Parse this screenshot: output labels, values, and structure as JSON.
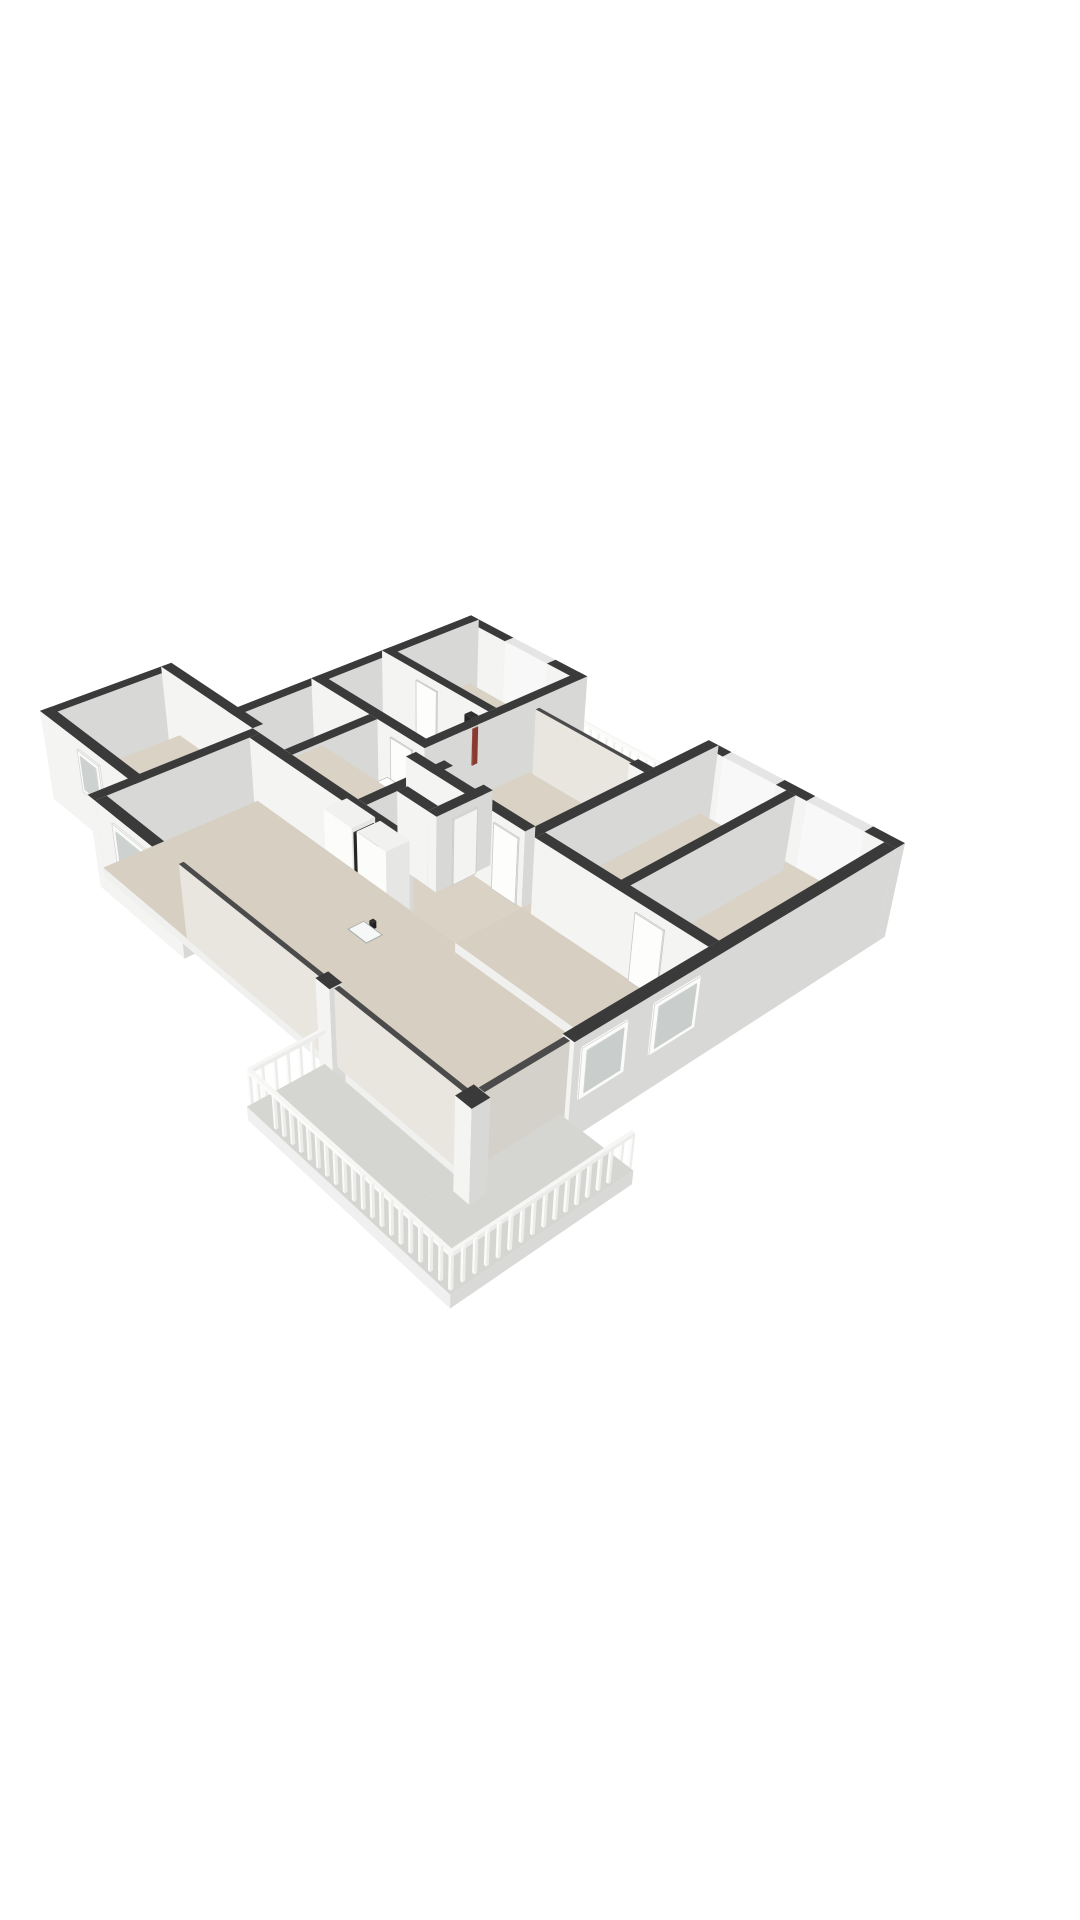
{
  "meta": {
    "description": "3D isometric floor plan of an apartment, viewed from the south-east above. White background, dark wall caps, white and grey walls, beige room floors, grey balcony floors, two balconies with white slatted railings, kitchen island with cooktop and sink, bathroom with wooden vanity, bathtub and shower, utility closet with boiler and meter cupboard.",
    "image_width": 1080,
    "image_height": 1920
  },
  "palette": {
    "background": "#ffffff",
    "wall_top": "#3a3a3b",
    "wall_south_face": "#f4f4f3",
    "wall_east_face": "#d8d8d7",
    "floor_room": "#d9d2c5",
    "floor_living": "#d7cfc1",
    "floor_balcony": "#d5d6d1",
    "railing_white": "#f6f6f5",
    "glass_face": "#e9e6e0",
    "furniture_white": "#f1f1ef",
    "wood_vanity": "#cfa87f",
    "cooktop_black": "#1d1d1f",
    "dark_cabinet": "#262627",
    "accent_red": "#8a3b2f",
    "door_white": "#fdfdfc"
  },
  "camera": {
    "eye": [
      33.0,
      29.9,
      24.9
    ],
    "target": [
      7.0,
      8.0,
      0.0
    ],
    "fit_frame": [
      40,
      428,
      905,
      1496
    ]
  },
  "kinds": {
    "wall": {
      "ft": "#3a3a3b",
      "fs": "#f4f4f3",
      "fe": "#d8d8d7"
    },
    "winN": {
      "ft": "#e4e5e4",
      "fs": "#f7f8f7",
      "fe": "#edeeed"
    },
    "glass": {
      "ft": "#4b4b4c",
      "fs": "#e9e6e0",
      "fe": "#d4d1ca"
    },
    "slab": {
      "ft": "#d9d2c5",
      "fs": "#f0f0ef",
      "fe": "#dadad9"
    },
    "slabL": {
      "ft": "#d7cfc1",
      "fs": "#f0f0ef",
      "fe": "#dadad9"
    },
    "slabB": {
      "ft": "#d5d6d1",
      "fs": "#eff0ef",
      "fe": "#d9dad8"
    },
    "rail": {
      "ft": "#f6f6f5",
      "fs": "#fbfbfa",
      "fe": "#ececeb"
    },
    "furn": {
      "ft": "#f1f1ef",
      "fs": "#fcfcfb",
      "fe": "#e6e6e4"
    },
    "wood": {
      "ft": "#f7f6f3",
      "fs": "#cfa87f",
      "fe": "#b8905e"
    },
    "dark": {
      "ft": "#2e2e2f",
      "fs": "#262627",
      "fe": "#1f1f20"
    },
    "door": {
      "ft": "#fdfdfc",
      "fs": "#fdfdfc",
      "fe": "#f3f3f1",
      "stroke": "#c9c9c7"
    },
    "dec": {}
  },
  "boxes": [
    {
      "id": "wall-wing-north-a",
      "k": "wall",
      "b": [
        -0.2,
        -0.2,
        1.7,
        0.15,
        -0.55,
        2.35
      ]
    },
    {
      "id": "window-wing-north",
      "k": "winN",
      "b": [
        1.7,
        -0.2,
        3.5,
        0.15,
        -0.55,
        2.35
      ]
    },
    {
      "id": "wall-wing-north-b",
      "k": "wall",
      "b": [
        3.5,
        -0.2,
        4.8,
        0.15,
        -0.55,
        2.35
      ]
    },
    {
      "id": "wall-wing-west",
      "k": "wall",
      "b": [
        -0.2,
        -0.2,
        0.15,
        8.95,
        -0.55,
        2.35
      ]
    },
    {
      "id": "wall-wing-east",
      "k": "wall",
      "b": [
        4.45,
        -0.2,
        4.8,
        5.9,
        0,
        2.35
      ]
    },
    {
      "id": "wall-study-south",
      "k": "wall",
      "b": [
        -0.2,
        3.0,
        4.45,
        3.3,
        0,
        2.35
      ]
    },
    {
      "id": "wall-wing-south",
      "k": "wall",
      "b": [
        -0.2,
        5.55,
        4.8,
        5.9,
        0,
        2.35
      ]
    },
    {
      "id": "wall-bed1-north-a",
      "k": "wall",
      "b": [
        4.8,
        1.95,
        5.15,
        2.3,
        0,
        2.35
      ]
    },
    {
      "id": "slider-bed1-balcony",
      "k": "glass",
      "b": [
        5.15,
        2.02,
        8.85,
        2.16,
        0,
        2.3
      ]
    },
    {
      "id": "wall-bed1-north-b",
      "k": "wall",
      "b": [
        8.85,
        1.95,
        9.4,
        2.3,
        0,
        2.35
      ]
    },
    {
      "id": "wall-block-west",
      "k": "wall",
      "b": [
        9.4,
        -0.2,
        9.75,
        6.55,
        0,
        2.35
      ]
    },
    {
      "id": "wall-block-north-a",
      "k": "wall",
      "b": [
        9.75,
        -0.2,
        10.2,
        0.15,
        -0.55,
        2.35
      ]
    },
    {
      "id": "window-block-north-1",
      "k": "winN",
      "b": [
        10.2,
        -0.2,
        12.0,
        0.15,
        -0.55,
        2.35
      ]
    },
    {
      "id": "wall-block-north-b",
      "k": "wall",
      "b": [
        12.0,
        -0.2,
        13.0,
        0.15,
        -0.55,
        2.35
      ]
    },
    {
      "id": "window-block-north-2",
      "k": "winN",
      "b": [
        13.0,
        -0.2,
        14.8,
        0.15,
        -0.55,
        2.35
      ]
    },
    {
      "id": "wall-block-north-c",
      "k": "wall",
      "b": [
        14.8,
        -0.2,
        15.75,
        0.15,
        -0.55,
        2.35
      ]
    },
    {
      "id": "wall-east-facade",
      "k": "wall",
      "b": [
        15.4,
        0.15,
        15.75,
        11.1,
        -0.55,
        2.35
      ]
    },
    {
      "id": "slider-corner-east",
      "k": "glass",
      "b": [
        15.44,
        11.1,
        15.62,
        13.5,
        0,
        2.3
      ]
    },
    {
      "id": "column-corner",
      "k": "wall",
      "b": [
        15.35,
        13.55,
        15.85,
        14.05,
        -0.4,
        2.35
      ]
    },
    {
      "id": "wall-bed-divider",
      "k": "wall",
      "b": [
        12.35,
        0.15,
        12.65,
        6.55,
        0,
        2.35
      ]
    },
    {
      "id": "wall-bed1-south",
      "k": "wall",
      "b": [
        4.8,
        6.2,
        9.4,
        6.55,
        0,
        2.35
      ]
    },
    {
      "id": "wall-block-south",
      "k": "wall",
      "b": [
        9.75,
        6.2,
        15.4,
        6.55,
        0,
        2.35
      ]
    },
    {
      "id": "wall-bath-west",
      "k": "wall",
      "b": [
        2.45,
        5.9,
        2.8,
        8.8,
        0,
        2.35
      ]
    },
    {
      "id": "wall-bath-east",
      "k": "wall",
      "b": [
        5.6,
        5.9,
        5.95,
        8.8,
        0,
        2.35
      ]
    },
    {
      "id": "wall-toilet-east",
      "k": "wall",
      "b": [
        7.15,
        5.9,
        7.5,
        7.8,
        0,
        2.35
      ]
    },
    {
      "id": "wall-toilet-south",
      "k": "wall",
      "b": [
        5.95,
        7.45,
        7.15,
        7.8,
        0,
        2.35
      ]
    },
    {
      "id": "wall-kitchen-divider",
      "k": "wall",
      "b": [
        1.35,
        8.8,
        7.8,
        9.15,
        0,
        2.35
      ]
    },
    {
      "id": "wall-leftwing-north",
      "k": "wall",
      "b": [
        -3.55,
        8.45,
        1.0,
        8.8,
        -0.55,
        2.35
      ]
    },
    {
      "id": "wall-leftwing-west",
      "k": "wall",
      "b": [
        -3.55,
        8.8,
        -3.2,
        12.75,
        -0.55,
        2.35
      ]
    },
    {
      "id": "wall-leftwing-south",
      "k": "wall",
      "b": [
        -3.55,
        12.4,
        1.35,
        12.75,
        -0.55,
        2.35
      ]
    },
    {
      "id": "wall-living-west",
      "k": "wall",
      "b": [
        1.0,
        8.8,
        1.35,
        13.95,
        -0.55,
        2.35
      ]
    },
    {
      "id": "wall-living-south-a",
      "k": "wall",
      "b": [
        1.35,
        13.6,
        5.0,
        13.95,
        -0.55,
        2.35
      ]
    },
    {
      "id": "slider-living-south",
      "k": "glass",
      "b": [
        5.0,
        13.68,
        10.6,
        13.82,
        0,
        2.3
      ]
    },
    {
      "id": "wall-living-south-b",
      "k": "wall",
      "b": [
        10.6,
        13.6,
        11.1,
        13.95,
        -0.55,
        2.35
      ]
    },
    {
      "id": "slider-corner-south",
      "k": "glass",
      "b": [
        11.1,
        13.68,
        15.35,
        13.82,
        0,
        2.3
      ]
    },
    {
      "id": "floor-wing",
      "k": "slab",
      "b": [
        -0.2,
        -0.2,
        4.8,
        5.9,
        -0.3,
        0
      ]
    },
    {
      "id": "floor-hall-bath",
      "k": "slab",
      "b": [
        -0.2,
        5.6,
        9.4,
        8.8,
        -0.3,
        0
      ]
    },
    {
      "id": "floor-bed1",
      "k": "slab",
      "b": [
        4.8,
        1.95,
        9.4,
        6.4,
        -0.3,
        0
      ]
    },
    {
      "id": "floor-block",
      "k": "slab",
      "b": [
        9.4,
        -0.2,
        15.6,
        6.55,
        -0.3,
        0
      ]
    },
    {
      "id": "floor-dining",
      "k": "slabL",
      "b": [
        9.4,
        6.55,
        15.6,
        8.8,
        -0.3,
        0
      ]
    },
    {
      "id": "floor-living",
      "k": "slabL",
      "b": [
        1.0,
        8.8,
        15.6,
        13.8,
        -0.3,
        0
      ]
    },
    {
      "id": "floor-leftwing",
      "k": "slab",
      "b": [
        -3.4,
        8.5,
        1.35,
        12.6,
        -0.3,
        0
      ]
    },
    {
      "id": "floor-balcony-top",
      "k": "slabB",
      "b": [
        4.6,
        -0.05,
        9.4,
        1.95,
        -0.35,
        -0.04
      ]
    },
    {
      "id": "floor-balcony-south-a",
      "k": "slabB",
      "b": [
        10.8,
        13.95,
        15.4,
        16.1,
        -0.45,
        -0.04
      ]
    },
    {
      "id": "floor-balcony-south-b",
      "k": "slabB",
      "b": [
        15.4,
        11.0,
        17.6,
        16.1,
        -0.45,
        -0.04
      ]
    },
    {
      "id": "kitchen-island",
      "k": "furn",
      "b": [
        6.2,
        10.6,
        9.3,
        11.4,
        0,
        0.95
      ]
    },
    {
      "id": "cooktop",
      "k": "dec",
      "c": "#1d1d1f",
      "b": [
        6.45,
        10.72,
        7.5,
        11.28,
        0.95,
        0.96
      ],
      "bias": 0.3
    },
    {
      "id": "island-sink",
      "k": "dec",
      "c": "#f6f7f7",
      "stroke": "#a9adac",
      "b": [
        8.25,
        10.76,
        8.95,
        11.24,
        0.95,
        0.96
      ],
      "bias": 0.3
    },
    {
      "id": "island-faucet",
      "k": "dark",
      "b": [
        8.52,
        10.68,
        8.64,
        10.8,
        0.95,
        1.16
      ],
      "bias": 0.32
    },
    {
      "id": "kitchen-cabinet-1",
      "k": "furn",
      "b": [
        5.2,
        8.85,
        6.35,
        9.6,
        0,
        2.2
      ]
    },
    {
      "id": "kitchen-cabinet-slot",
      "k": "dark",
      "b": [
        6.35,
        8.9,
        6.55,
        9.55,
        0,
        2.05
      ]
    },
    {
      "id": "kitchen-cabinet-2",
      "k": "furn",
      "b": [
        6.55,
        8.85,
        7.7,
        9.6,
        0,
        2.2
      ]
    },
    {
      "id": "bath-vanity",
      "k": "wood",
      "b": [
        3.3,
        6.0,
        4.4,
        6.62,
        0,
        0.85
      ]
    },
    {
      "id": "vanity-basin",
      "k": "dec",
      "c": "#ffffff",
      "stroke": "#b9bdbc",
      "b": [
        3.45,
        6.1,
        4.25,
        6.5,
        0.85,
        0.86
      ],
      "bias": 0.3
    },
    {
      "id": "bathtub",
      "k": "furn",
      "b": [
        2.7,
        7.95,
        4.35,
        8.62,
        0,
        0.55
      ]
    },
    {
      "id": "bathtub-inner",
      "k": "dec",
      "c": "#e2e5e4",
      "stroke": "#c2c6c5",
      "b": [
        2.85,
        8.08,
        4.2,
        8.5,
        0.55,
        0.56
      ],
      "bias": 0.3
    },
    {
      "id": "shower-floor",
      "k": "dec",
      "c": "#cbcdc9",
      "b": [
        2.65,
        6.85,
        3.6,
        7.8,
        0.01,
        0.02
      ],
      "bias": 0.2
    },
    {
      "id": "toilet-bowl",
      "k": "furn",
      "b": [
        6.25,
        6.6,
        6.7,
        7.05,
        0,
        0.4
      ]
    },
    {
      "id": "toilet-tank",
      "k": "furn",
      "b": [
        6.25,
        6.38,
        6.7,
        6.6,
        0,
        0.72
      ]
    },
    {
      "id": "boiler-unit",
      "k": "furn",
      "b": [
        2.8,
        3.35,
        3.5,
        4.05,
        0,
        0.92
      ]
    },
    {
      "id": "meter-cupboard",
      "k": "dark",
      "b": [
        3.75,
        3.3,
        4.05,
        3.55,
        0,
        2.05
      ]
    },
    {
      "id": "meter-accent",
      "k": "dec",
      "c": "#8a3b2f",
      "b": [
        4.05,
        3.32,
        4.08,
        3.52,
        0.5,
        1.7
      ],
      "bias": 0.25
    },
    {
      "id": "door-study",
      "k": "door",
      "b": [
        1.4,
        3.3,
        2.3,
        3.34,
        0,
        2.05
      ],
      "bias": 0.25
    },
    {
      "id": "door-hall-1",
      "k": "door",
      "b": [
        0.5,
        5.9,
        1.4,
        5.94,
        0,
        2.05
      ],
      "bias": 0.25
    },
    {
      "id": "door-hall-2",
      "k": "door",
      "b": [
        3.4,
        5.9,
        4.3,
        5.94,
        0,
        2.05
      ],
      "bias": 0.25
    },
    {
      "id": "door-bed1",
      "k": "door",
      "b": [
        8.3,
        6.55,
        9.2,
        6.59,
        0,
        2.05
      ],
      "bias": 0.25
    },
    {
      "id": "door-bed2",
      "k": "door",
      "b": [
        10.3,
        6.55,
        11.2,
        6.59,
        0,
        2.05
      ],
      "bias": 0.25
    },
    {
      "id": "door-bed3",
      "k": "door",
      "b": [
        13.2,
        6.55,
        14.1,
        6.59,
        0,
        2.05
      ],
      "bias": 0.25
    },
    {
      "id": "door-bathroom",
      "k": "door",
      "b": [
        5.95,
        6.4,
        5.99,
        7.3,
        0,
        2.05
      ],
      "bias": 0.25
    },
    {
      "id": "door-toilet",
      "k": "door",
      "b": [
        7.5,
        6.45,
        7.54,
        7.25,
        0,
        2.05
      ],
      "bias": 0.25
    },
    {
      "id": "door-leftwing",
      "k": "door",
      "b": [
        1.35,
        9.8,
        1.39,
        10.7,
        0,
        2.05
      ],
      "bias": 0.25
    },
    {
      "id": "window-east-1",
      "k": "dec",
      "c": "#fbfbfa",
      "stroke": "#d8d8d6",
      "b": [
        15.75,
        0.6,
        15.8,
        2.2,
        0.7,
        2.1
      ],
      "bias": 0.25
    },
    {
      "id": "window-east-1-glass",
      "k": "dec",
      "c": "#c9cecc",
      "b": [
        15.8,
        0.74,
        15.82,
        2.06,
        0.84,
        1.97
      ],
      "bias": 0.3
    },
    {
      "id": "window-east-2",
      "k": "dec",
      "c": "#fbfbfa",
      "stroke": "#d8d8d6",
      "b": [
        15.75,
        3.2,
        15.8,
        4.8,
        0.7,
        2.1
      ],
      "bias": 0.25
    },
    {
      "id": "window-east-2-glass",
      "k": "dec",
      "c": "#c9cecc",
      "b": [
        15.8,
        3.34,
        15.82,
        4.66,
        0.84,
        1.97
      ],
      "bias": 0.3
    },
    {
      "id": "window-east-3",
      "k": "dec",
      "c": "#fbfbfa",
      "stroke": "#d8d8d6",
      "b": [
        15.75,
        7.2,
        15.8,
        8.7,
        0.6,
        2.1
      ],
      "bias": 0.25
    },
    {
      "id": "window-east-3-glass",
      "k": "dec",
      "c": "#c9cecc",
      "b": [
        15.8,
        7.34,
        15.82,
        8.56,
        0.74,
        1.97
      ],
      "bias": 0.3
    },
    {
      "id": "window-east-4",
      "k": "dec",
      "c": "#fbfbfa",
      "stroke": "#d8d8d6",
      "b": [
        15.75,
        9.5,
        15.8,
        10.9,
        0.6,
        2.1
      ],
      "bias": 0.25
    },
    {
      "id": "window-east-4-glass",
      "k": "dec",
      "c": "#c9cecc",
      "b": [
        15.8,
        9.64,
        15.82,
        10.76,
        0.74,
        1.97
      ],
      "bias": 0.3
    },
    {
      "id": "window-living-south",
      "k": "dec",
      "c": "#fbfbfa",
      "stroke": "#d8d8d6",
      "b": [
        2.2,
        13.95,
        4.6,
        14.0,
        0.25,
        2.1
      ],
      "bias": 0.25
    },
    {
      "id": "window-living-south-glass",
      "k": "dec",
      "c": "#cdd2d0",
      "b": [
        2.36,
        14.0,
        4.44,
        14.02,
        0.42,
        1.95
      ],
      "bias": 0.3
    },
    {
      "id": "window-leftwing-1",
      "k": "dec",
      "c": "#fbfbfa",
      "stroke": "#d8d8d6",
      "b": [
        -3.1,
        12.75,
        -2.0,
        12.8,
        0.7,
        2.05
      ],
      "bias": 0.25
    },
    {
      "id": "window-leftwing-1-glass",
      "k": "dec",
      "c": "#cdd2d0",
      "b": [
        -2.96,
        12.8,
        -2.14,
        12.82,
        0.84,
        1.92
      ],
      "bias": 0.3
    },
    {
      "id": "window-leftwing-2",
      "k": "dec",
      "c": "#fbfbfa",
      "stroke": "#d8d8d6",
      "b": [
        -1.55,
        12.75,
        -0.45,
        12.8,
        0.7,
        2.05
      ],
      "bias": 0.25
    },
    {
      "id": "window-leftwing-2-glass",
      "k": "dec",
      "c": "#cdd2d0",
      "b": [
        -1.41,
        12.8,
        -0.59,
        12.82,
        0.84,
        1.92
      ],
      "bias": 0.3
    }
  ],
  "railings": [
    {
      "id": "railing-balcony-top",
      "axis": "x",
      "fixed": 0.06,
      "from": 4.68,
      "to": 9.38
    },
    {
      "id": "railing-balcony2-east",
      "axis": "y",
      "fixed": 17.52,
      "from": 11.05,
      "to": 16.02
    },
    {
      "id": "railing-balcony2-south",
      "axis": "x",
      "fixed": 16.02,
      "from": 10.88,
      "to": 17.52
    },
    {
      "id": "railing-balcony2-west",
      "axis": "y",
      "fixed": 10.88,
      "from": 13.98,
      "to": 16.02
    }
  ],
  "railing_style": {
    "slat_step": 0.3,
    "slat_w": 0.07,
    "slat_h": 1.0,
    "toprail_z1": 0.97,
    "toprail_z2": 1.09,
    "toprail_th": 0.09
  }
}
